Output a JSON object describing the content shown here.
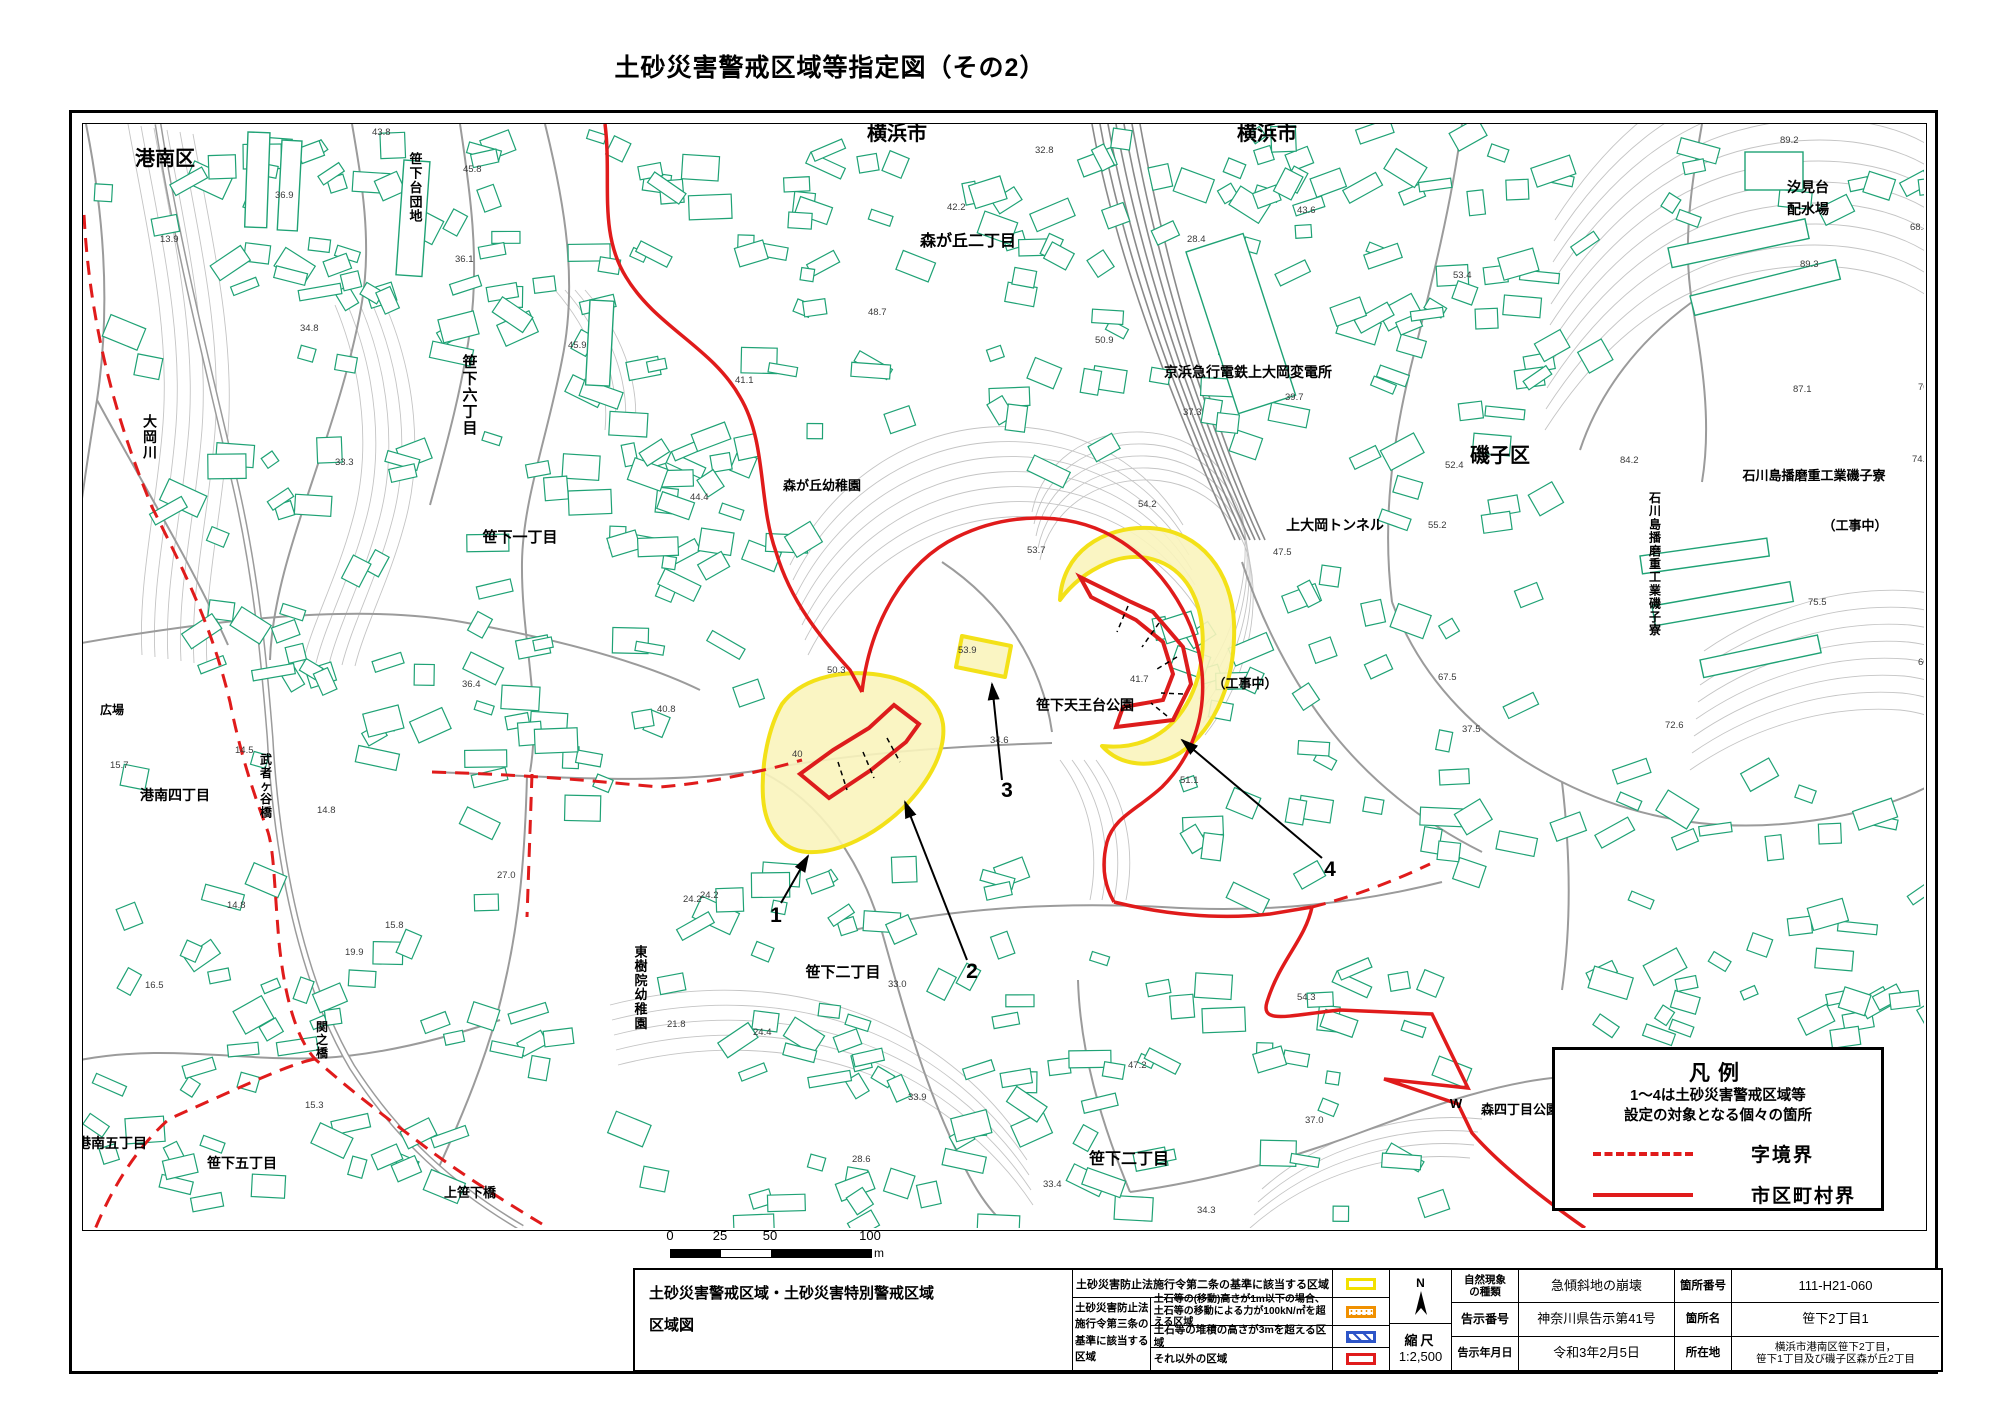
{
  "title": "土砂災害警戒区域等指定図（その2）",
  "legend": {
    "title": "凡例",
    "desc_line1": "1～4は土砂災害警戒区域等",
    "desc_line2": "設定の対象となる個々の箇所",
    "items": [
      {
        "style": "dashed",
        "label": "字境界"
      },
      {
        "style": "solid",
        "label": "市区町村界"
      }
    ]
  },
  "scalebar": {
    "labels": [
      "0",
      "25",
      "50",
      "100"
    ],
    "unit": "m"
  },
  "table": {
    "main_title_line1": "土砂災害警戒区域・土砂災害特別警戒区域",
    "main_title_line2": "区域図",
    "law2_text": "土砂災害防止法施行令第二条の基準に該当する区域",
    "law3_l1": "土砂災害防止法",
    "law3_l2": "施行令第三条の",
    "law3_l3": "基準に該当する",
    "law3_l4": "区域",
    "row2_desc_line1": "土石等の(移動)高さが1m以下の場合、",
    "row2_desc_line2": "土石等の移動による力が100kN/㎡を超える区域",
    "row3_desc": "土石等の堆積の高さが3mを超える区域",
    "row4_desc": "それ以外の区域",
    "north": "N",
    "scale_label": "縮尺",
    "scale_value": "1:2,500",
    "fields": {
      "nat_label_l1": "自然現象",
      "nat_label_l2": "の種類",
      "nat_value": "急傾斜地の崩壊",
      "num_label": "箇所番号",
      "num_value": "111-H21-060",
      "notice_label": "告示番号",
      "notice_value": "神奈川県告示第41号",
      "name_label": "箇所名",
      "name_value": "笹下2丁目1",
      "date_label": "告示年月日",
      "date_value": "令和3年2月5日",
      "loc_label": "所在地",
      "loc_value_l1": "横浜市港南区笹下2丁目，",
      "loc_value_l2": "笹下1丁目及び磯子区森が丘2丁目"
    }
  },
  "map": {
    "colors": {
      "building": "#1fa275",
      "road": "#9b9b9b",
      "contour": "#c4c4c4",
      "red": "#e01b1b",
      "zone_red": "#dd1c1c",
      "yellow_fill": "#faf4bc",
      "yellow_stroke": "#f3e118",
      "rail": "#8a8a8a",
      "text": "#000"
    },
    "region_labels": [
      {
        "t": "横浜市",
        "x": 897,
        "y": 140,
        "s": 20
      },
      {
        "t": "横浜市",
        "x": 1267,
        "y": 140,
        "s": 20
      },
      {
        "t": "港南区",
        "x": 165,
        "y": 165,
        "s": 20
      },
      {
        "t": "磯子区",
        "x": 1500,
        "y": 462,
        "s": 20
      },
      {
        "t": "森が丘二丁目",
        "x": 968,
        "y": 246,
        "s": 16
      },
      {
        "t": "森が丘幼稚園",
        "x": 822,
        "y": 490,
        "s": 13
      },
      {
        "t": "笹下六丁目",
        "x": 470,
        "y": 400,
        "s": 15,
        "v": true
      },
      {
        "t": "笹下一丁目",
        "x": 520,
        "y": 542,
        "s": 15
      },
      {
        "t": "笹下台団地",
        "x": 416,
        "y": 192,
        "s": 13,
        "v": true
      },
      {
        "t": "京浜急行電鉄上大岡変電所",
        "x": 1248,
        "y": 377,
        "s": 14
      },
      {
        "t": "上大岡トンネル",
        "x": 1335,
        "y": 530,
        "s": 14
      },
      {
        "t": "汐見台",
        "x": 1808,
        "y": 192,
        "s": 14
      },
      {
        "t": "配水場",
        "x": 1808,
        "y": 214,
        "s": 14
      },
      {
        "t": "石川島播磨重工業磯子寮",
        "x": 1814,
        "y": 480,
        "s": 13
      },
      {
        "t": "石川島播磨重工業磯子寮",
        "x": 1655,
        "y": 568,
        "s": 12,
        "v": true
      },
      {
        "t": "（工事中）",
        "x": 1855,
        "y": 530,
        "s": 13
      },
      {
        "t": "（工事中）",
        "x": 1245,
        "y": 688,
        "s": 13
      },
      {
        "t": "笹下天王台公園",
        "x": 1085,
        "y": 710,
        "s": 14
      },
      {
        "t": "東樹院幼稚園",
        "x": 641,
        "y": 992,
        "s": 13,
        "v": true
      },
      {
        "t": "笹下二丁目",
        "x": 843,
        "y": 977,
        "s": 15
      },
      {
        "t": "笹下二丁目",
        "x": 1129,
        "y": 1164,
        "s": 16
      },
      {
        "t": "港南四丁目",
        "x": 175,
        "y": 800,
        "s": 14
      },
      {
        "t": "港南五丁目",
        "x": 112,
        "y": 1148,
        "s": 14
      },
      {
        "t": "笹下五丁目",
        "x": 242,
        "y": 1168,
        "s": 14
      },
      {
        "t": "上笹下橋",
        "x": 470,
        "y": 1197,
        "s": 13
      },
      {
        "t": "武者ヶ谷橋",
        "x": 266,
        "y": 790,
        "s": 12,
        "v": true
      },
      {
        "t": "関之橋",
        "x": 322,
        "y": 1044,
        "s": 12,
        "v": true
      },
      {
        "t": "大岡川",
        "x": 150,
        "y": 442,
        "s": 14,
        "v": true
      },
      {
        "t": "広場",
        "x": 112,
        "y": 714,
        "s": 12
      },
      {
        "t": "森四丁目公園",
        "x": 1520,
        "y": 1114,
        "s": 13
      },
      {
        "t": "W",
        "x": 1456,
        "y": 1108,
        "s": 13
      }
    ],
    "elevations": [
      {
        "v": "45.8",
        "x": 463,
        "y": 172
      },
      {
        "v": "36.9",
        "x": 275,
        "y": 198
      },
      {
        "v": "13.9",
        "x": 160,
        "y": 242
      },
      {
        "v": "34.8",
        "x": 300,
        "y": 331
      },
      {
        "v": "45.9",
        "x": 568,
        "y": 348
      },
      {
        "v": "41.1",
        "x": 735,
        "y": 383
      },
      {
        "v": "44.4",
        "x": 690,
        "y": 500
      },
      {
        "v": "40.8",
        "x": 657,
        "y": 712
      },
      {
        "v": "36.4",
        "x": 462,
        "y": 687
      },
      {
        "v": "27.0",
        "x": 497,
        "y": 878
      },
      {
        "v": "24.2",
        "x": 700,
        "y": 898
      },
      {
        "v": "50.3",
        "x": 827,
        "y": 673
      },
      {
        "v": "40",
        "x": 792,
        "y": 757
      },
      {
        "v": "53.7",
        "x": 1027,
        "y": 553
      },
      {
        "v": "53.9",
        "x": 958,
        "y": 653
      },
      {
        "v": "41.7",
        "x": 1130,
        "y": 682
      },
      {
        "v": "34.6",
        "x": 990,
        "y": 743
      },
      {
        "v": "51.1",
        "x": 1180,
        "y": 783
      },
      {
        "v": "24.2",
        "x": 683,
        "y": 902
      },
      {
        "v": "33.0",
        "x": 888,
        "y": 987
      },
      {
        "v": "21.8",
        "x": 667,
        "y": 1027
      },
      {
        "v": "24.4",
        "x": 753,
        "y": 1035
      },
      {
        "v": "33.9",
        "x": 908,
        "y": 1100
      },
      {
        "v": "47.2",
        "x": 1128,
        "y": 1068
      },
      {
        "v": "37.0",
        "x": 1305,
        "y": 1123
      },
      {
        "v": "54.3",
        "x": 1297,
        "y": 1000
      },
      {
        "v": "33.4",
        "x": 1043,
        "y": 1187
      },
      {
        "v": "34.3",
        "x": 1197,
        "y": 1213
      },
      {
        "v": "28.6",
        "x": 852,
        "y": 1162
      },
      {
        "v": "15.7",
        "x": 110,
        "y": 768
      },
      {
        "v": "14.5",
        "x": 235,
        "y": 753
      },
      {
        "v": "14.8",
        "x": 317,
        "y": 813
      },
      {
        "v": "14.8",
        "x": 227,
        "y": 908
      },
      {
        "v": "16.5",
        "x": 145,
        "y": 988
      },
      {
        "v": "15.8",
        "x": 385,
        "y": 928
      },
      {
        "v": "15.3",
        "x": 305,
        "y": 1108
      },
      {
        "v": "89.2",
        "x": 1780,
        "y": 143
      },
      {
        "v": "89.3",
        "x": 1800,
        "y": 267
      },
      {
        "v": "87.1",
        "x": 1793,
        "y": 392
      },
      {
        "v": "84.2",
        "x": 1620,
        "y": 463
      },
      {
        "v": "74.1",
        "x": 1912,
        "y": 462
      },
      {
        "v": "75.5",
        "x": 1808,
        "y": 605
      },
      {
        "v": "72.6",
        "x": 1665,
        "y": 728
      },
      {
        "v": "60",
        "x": 1918,
        "y": 665
      },
      {
        "v": "37.3",
        "x": 1183,
        "y": 415
      },
      {
        "v": "39.7",
        "x": 1285,
        "y": 400
      },
      {
        "v": "52.4",
        "x": 1445,
        "y": 468
      },
      {
        "v": "53.4",
        "x": 1453,
        "y": 278
      },
      {
        "v": "54.2",
        "x": 1138,
        "y": 507
      },
      {
        "v": "47.5",
        "x": 1273,
        "y": 555
      },
      {
        "v": "55.2",
        "x": 1428,
        "y": 528
      },
      {
        "v": "32.8",
        "x": 1035,
        "y": 153
      },
      {
        "v": "42.2",
        "x": 947,
        "y": 210
      },
      {
        "v": "48.7",
        "x": 868,
        "y": 315
      },
      {
        "v": "50.9",
        "x": 1095,
        "y": 343
      },
      {
        "v": "28.4",
        "x": 1187,
        "y": 242
      },
      {
        "v": "43.6",
        "x": 1297,
        "y": 213
      },
      {
        "v": "70.5",
        "x": 1918,
        "y": 390
      },
      {
        "v": "43.8",
        "x": 372,
        "y": 135
      },
      {
        "v": "36.1",
        "x": 455,
        "y": 262
      },
      {
        "v": "33.3",
        "x": 335,
        "y": 465
      },
      {
        "v": "19.9",
        "x": 345,
        "y": 955
      },
      {
        "v": "68.3",
        "x": 1910,
        "y": 230
      },
      {
        "v": "67.5",
        "x": 1438,
        "y": 680
      },
      {
        "v": "37.5",
        "x": 1462,
        "y": 732
      }
    ],
    "contour_bundles": [
      {
        "d": "M1545,430 C1600,345 1665,292 1745,274 C1825,256 1895,270 1936,302",
        "n": 11,
        "dx": 1,
        "dy": -21
      },
      {
        "d": "M1690,770 C1755,725 1830,705 1900,710 C1918,712 1930,716 1937,720",
        "n": 8,
        "dx": 2,
        "dy": -17
      },
      {
        "d": "M790,565 C830,485 905,432 990,427 C1072,422 1142,458 1183,525",
        "n": 7,
        "dx": 3,
        "dy": 15
      },
      {
        "d": "M128,124 C148,235 172,335 162,435 C155,515 138,585 142,655",
        "n": 6,
        "dx": 13,
        "dy": 2
      },
      {
        "d": "M610,1005 C700,982 785,987 855,1012 C925,1037 985,1085 1025,1145",
        "n": 5,
        "dx": 2,
        "dy": 15
      },
      {
        "d": "M335,305 C363,372 372,452 352,522 C337,577 313,622 303,662",
        "n": 5,
        "dx": 13,
        "dy": 1
      },
      {
        "d": "M1250,1228 C1310,1175 1390,1150 1470,1158",
        "n": 4,
        "dx": 4,
        "dy": -13
      },
      {
        "d": "M1040,560 C1050,510 1095,478 1150,480 C1205,482 1245,520 1252,575 C1258,630 1240,690 1205,735",
        "n": 5,
        "dx": -2,
        "dy": -12
      },
      {
        "d": "M585,290 C620,330 640,380 635,430",
        "n": 4,
        "dx": -10,
        "dy": 0
      },
      {
        "d": "M1060,760 C1090,800 1100,850 1090,900",
        "n": 4,
        "dx": 12,
        "dy": 0
      }
    ],
    "roads": [
      "M86,124 C102,205 112,300 97,400 C88,455 80,510 74,560",
      "M545,124 C565,205 578,282 562,360 C547,438 523,500 522,562 C521,640 542,702 530,772",
      "M70,645 C200,622 352,602 462,622 C562,640 642,662 700,690",
      "M432,772 C530,775 652,787 762,770 C852,753 952,746 1052,743",
      "M762,772 C822,802 862,862 882,932 C902,1002 922,1082 962,1162 C985,1210 1005,1225 1012,1228",
      "M527,775 C525,852 520,917 505,982 C490,1052 460,1122 432,1182",
      "M70,1062 C162,1042 242,1062 322,1058 C380,1055 440,1040 500,1020",
      "M845,932 C952,907 1062,902 1162,907 C1272,914 1362,902 1442,882",
      "M1130,1192 C1202,1182 1282,1162 1362,1132 C1442,1102 1502,1082 1562,1077",
      "M1462,124 C1452,202 1432,282 1412,362 C1392,442 1382,522 1392,602",
      "M1392,602 C1422,682 1482,742 1562,782 C1642,822 1722,832 1802,822",
      "M1702,124 C1692,182 1682,242 1692,302 C1702,362 1712,422 1702,482",
      "M942,562 C1002,602 1042,662 1052,732",
      "M1242,562 C1262,622 1292,682 1332,732 C1372,782 1422,822 1482,852",
      "M352,124 C362,182 372,242 362,302 C352,362 332,422 312,482 C292,542 272,602 270,660",
      "M1130,1192 C1100,1120 1080,1050 1078,980",
      "M1562,782 C1570,850 1572,920 1562,990",
      "M97,400 C140,480 190,560 228,645",
      "M1802,822 C1860,815 1905,800 1936,782",
      "M1692,302 C1640,340 1600,390 1580,450",
      "M460,124 C470,190 480,260 470,330 C462,390 445,450 430,505"
    ],
    "river": "M158,124 C178,252 212,382 237,492 C257,582 264,662 270,737 C277,862 302,982 352,1067 C397,1137 452,1187 522,1228",
    "railway": {
      "n": 7,
      "x1": 1092,
      "sp1": 8,
      "x2": 1235,
      "sp2": 5,
      "y1": 124,
      "y2": 540
    },
    "boundary_solid": [
      "M605,124 C612,180 598,232 626,277 C656,327 712,347 740,397 C767,442 758,502 776,552 C791,602 820,637 850,670 L862,692",
      "M862,692 C870,622 905,562 957,537 C1012,510 1077,512 1122,542 C1167,572 1197,622 1202,672 C1206,717 1192,757 1162,787 C1137,810 1114,817 1107,842 C1100,870 1107,890 1114,902",
      "M1114,902 C1162,914 1217,920 1270,914 L1312,907",
      "M1312,907 C1305,940 1280,960 1267,1002 C1260,1025 1290,1015 1340,1010 L1432,1014 L1468,1088 L1384,1079 L1458,1104 L1472,1133 C1500,1165 1545,1200 1585,1228"
    ],
    "boundary_dashed": [
      "M84,215 C90,330 118,425 152,507 C187,577 212,627 230,702 C242,762 257,802 268,832 C274,852 274,882 279,942 C284,992 295,1037 315,1059 C352,1092 392,1122 432,1152 C462,1174 502,1200 542,1224",
      "M315,1059 C290,1064 252,1082 169,1119 C132,1152 107,1197 90,1242",
      "M432,772 C532,775 582,780 659,787 C702,784 762,772 802,760",
      "M532,774 L527,917",
      "M1312,907 C1352,897 1392,882 1430,864"
    ],
    "zones_yellow": [
      "M782,704 C800,680 836,670 873,674 C911,678 939,698 943,724 C946,750 931,780 903,808 C876,834 839,854 807,852 C781,850 765,828 763,797 C761,762 769,727 782,704 Z",
      "M962,636 L1011,646 L1005,677 L956,667 Z",
      "M1060,600 C1062,553 1102,526 1150,528 C1202,531 1232,573 1234,623 C1236,678 1217,728 1180,753 C1152,770 1120,766 1102,746 C1142,750 1172,733 1190,698 C1207,663 1207,618 1190,588 C1172,558 1137,550 1107,563 C1084,573 1070,586 1060,600 Z"
    ],
    "zones_red": [
      "M800,774 L829,798 L871,770 L906,742 L919,724 L894,705 L869,728 L833,750 Z",
      "M1080,577 L1131,602 L1153,612 L1183,647 L1191,684 L1173,720 L1116,727 L1123,707 L1163,700 L1173,674 L1163,642 L1136,620 L1091,597 Z"
    ],
    "section_ticks": [
      [
        838,
        762,
        847,
        790
      ],
      [
        863,
        752,
        874,
        778
      ],
      [
        887,
        738,
        900,
        762
      ],
      [
        1128,
        606,
        1117,
        632
      ],
      [
        1159,
        623,
        1142,
        647
      ],
      [
        1177,
        657,
        1157,
        669
      ],
      [
        1183,
        694,
        1161,
        693
      ],
      [
        1167,
        716,
        1151,
        703
      ]
    ],
    "callouts": [
      {
        "n": "1",
        "x": 776,
        "y": 922,
        "a": [
          781,
          903,
          808,
          856
        ]
      },
      {
        "n": "2",
        "x": 972,
        "y": 978,
        "a": [
          967,
          960,
          905,
          802
        ]
      },
      {
        "n": "3",
        "x": 1007,
        "y": 797,
        "a": [
          1002,
          780,
          992,
          684
        ]
      },
      {
        "n": "4",
        "x": 1330,
        "y": 876,
        "a": [
          1322,
          858,
          1182,
          740
        ]
      }
    ],
    "building_clusters": [
      [
        95,
        128,
        440,
        250,
        52,
        1
      ],
      [
        560,
        128,
        380,
        300,
        42,
        2
      ],
      [
        960,
        128,
        330,
        330,
        42,
        3
      ],
      [
        1310,
        130,
        270,
        250,
        30,
        4
      ],
      [
        1600,
        128,
        330,
        100,
        10,
        5
      ],
      [
        90,
        430,
        350,
        370,
        36,
        6
      ],
      [
        460,
        430,
        320,
        270,
        30,
        7
      ],
      [
        1150,
        565,
        370,
        320,
        40,
        8
      ],
      [
        1550,
        770,
        370,
        270,
        30,
        9
      ],
      [
        90,
        850,
        470,
        350,
        50,
        10
      ],
      [
        600,
        850,
        450,
        350,
        52,
        11
      ],
      [
        1060,
        950,
        420,
        260,
        36,
        12
      ],
      [
        620,
        420,
        200,
        150,
        14,
        13
      ],
      [
        1330,
        255,
        200,
        270,
        18,
        14
      ],
      [
        1600,
        950,
        300,
        85,
        10,
        15
      ],
      [
        1180,
        124,
        140,
        130,
        12,
        16
      ],
      [
        460,
        700,
        220,
        130,
        14,
        17
      ],
      [
        700,
        1180,
        380,
        45,
        8,
        18
      ]
    ],
    "slabs": [
      [
        404,
        160,
        26,
        115,
        4
      ],
      [
        1668,
        248,
        140,
        20,
        -12
      ],
      [
        1690,
        296,
        150,
        20,
        -14
      ],
      [
        1745,
        152,
        58,
        38,
        0
      ],
      [
        1640,
        556,
        128,
        18,
        -8
      ],
      [
        1652,
        606,
        140,
        20,
        -10
      ],
      [
        1700,
        660,
        120,
        18,
        -12
      ],
      [
        248,
        132,
        22,
        95,
        2
      ],
      [
        282,
        140,
        20,
        90,
        3
      ],
      [
        1186,
        252,
        60,
        170,
        -18
      ],
      [
        590,
        300,
        24,
        85,
        3
      ]
    ]
  }
}
